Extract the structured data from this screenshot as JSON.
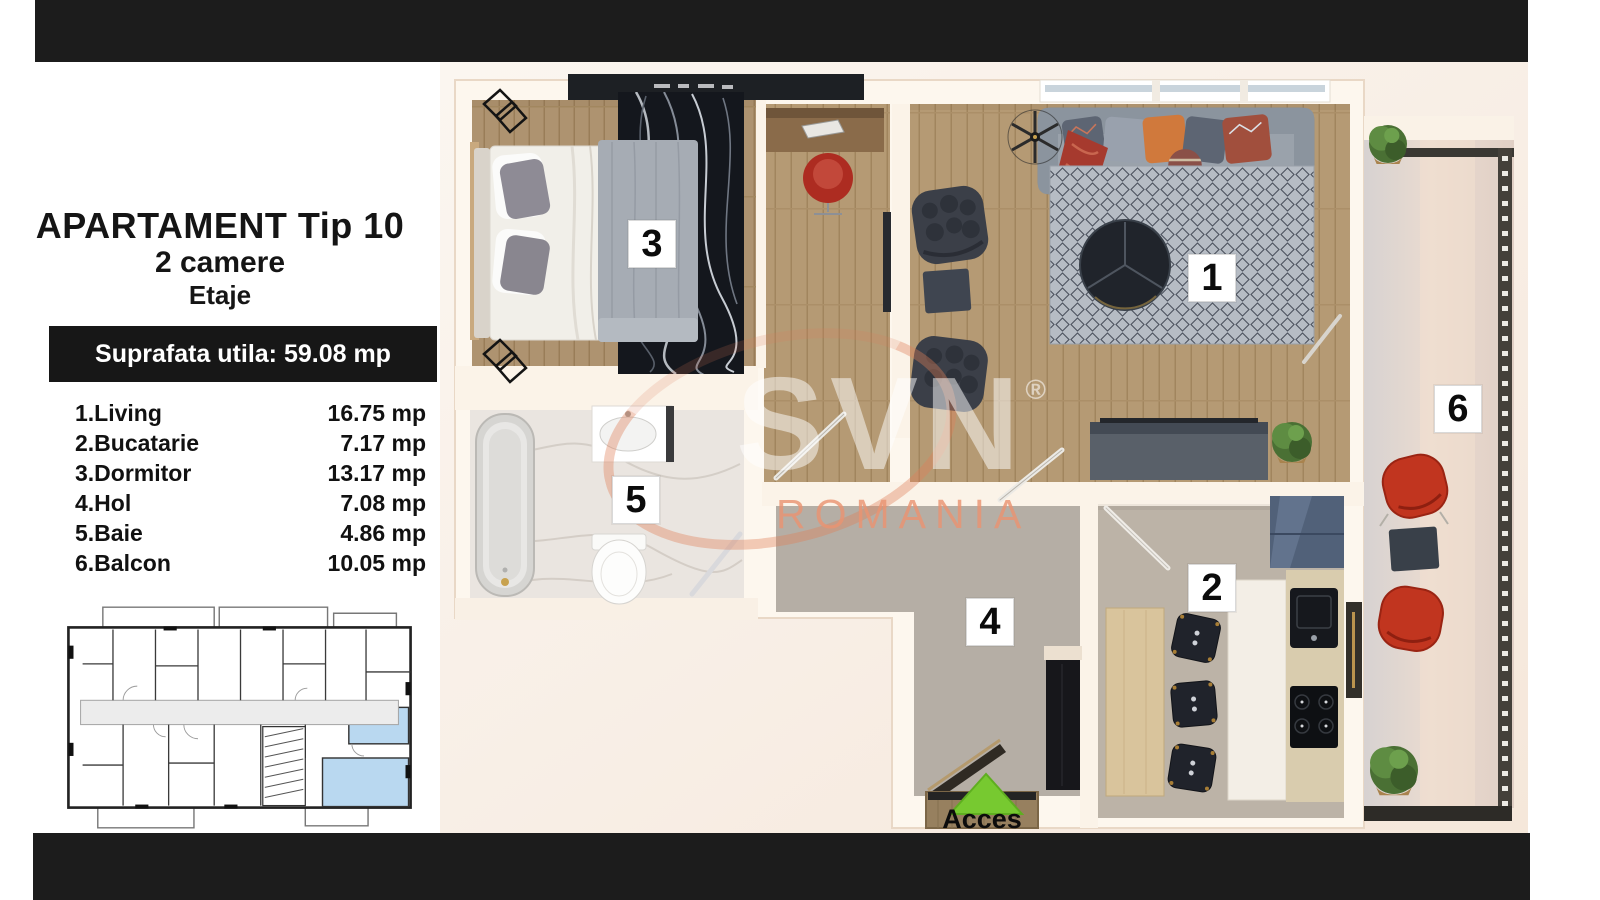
{
  "panel": {
    "title": "APARTAMENT Tip 10",
    "subtitle": "2 camere",
    "level": "Etaje",
    "area_banner": "Suprafata utila: 59.08 mp",
    "rooms": [
      {
        "label": "1.Living",
        "area": "16.75 mp"
      },
      {
        "label": "2.Bucatarie",
        "area": "7.17 mp"
      },
      {
        "label": "3.Dormitor",
        "area": "13.17 mp"
      },
      {
        "label": "4.Hol",
        "area": "7.08 mp"
      },
      {
        "label": "5.Baie",
        "area": "4.86 mp"
      },
      {
        "label": "6.Balcon",
        "area": "10.05 mp"
      }
    ]
  },
  "plan": {
    "room_markers": {
      "living": "1",
      "kitchen": "2",
      "bedroom": "3",
      "hall": "4",
      "bath": "5",
      "balcony": "6"
    },
    "access_label": "Acces",
    "watermark": {
      "brand": "SVN",
      "registered": "®",
      "country": "ROMANIA"
    }
  },
  "colors": {
    "bar": "#1c1c1c",
    "accent_green": "#77c930",
    "highlight_blue": "#b9d8f0",
    "watermark_salmon": "#e8986f"
  }
}
